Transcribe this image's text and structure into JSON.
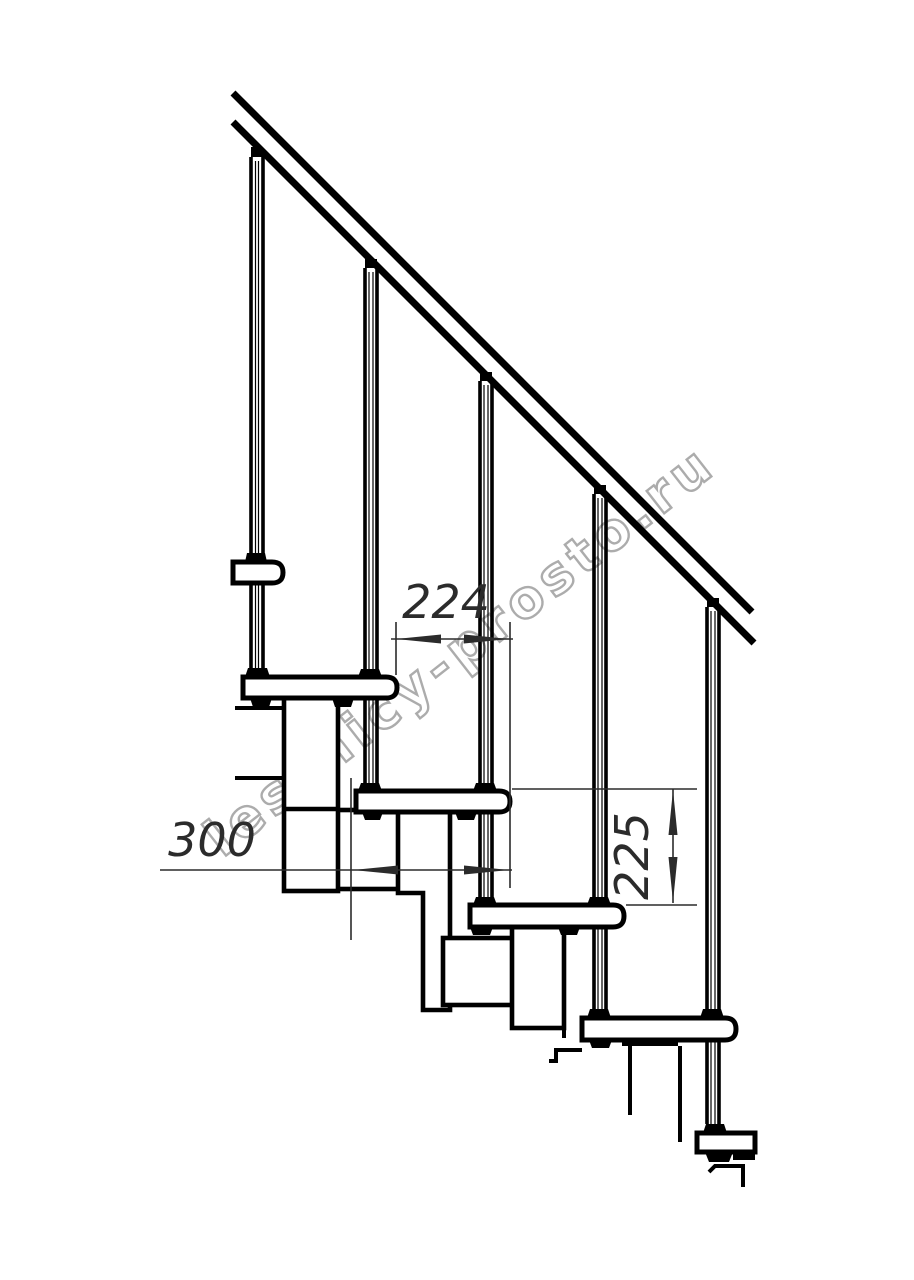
{
  "page": {
    "background": "#ffffff"
  },
  "watermark": {
    "text": "lestnicy-prosto.ru",
    "color": "#a3a3a3"
  },
  "drawing": {
    "description": "Modular staircase side elevation drawing",
    "handrail_count": 1,
    "baluster_count": 5,
    "tread_count": 6,
    "dimensions": [
      {
        "id": "step-run",
        "label": "224"
      },
      {
        "id": "tread-depth",
        "label": "300"
      },
      {
        "id": "step-rise",
        "label": "225"
      }
    ]
  },
  "colors": {
    "line": "#000000",
    "dimension": "#2b2b2b",
    "watermark": "#a3a3a3",
    "background": "#ffffff"
  }
}
